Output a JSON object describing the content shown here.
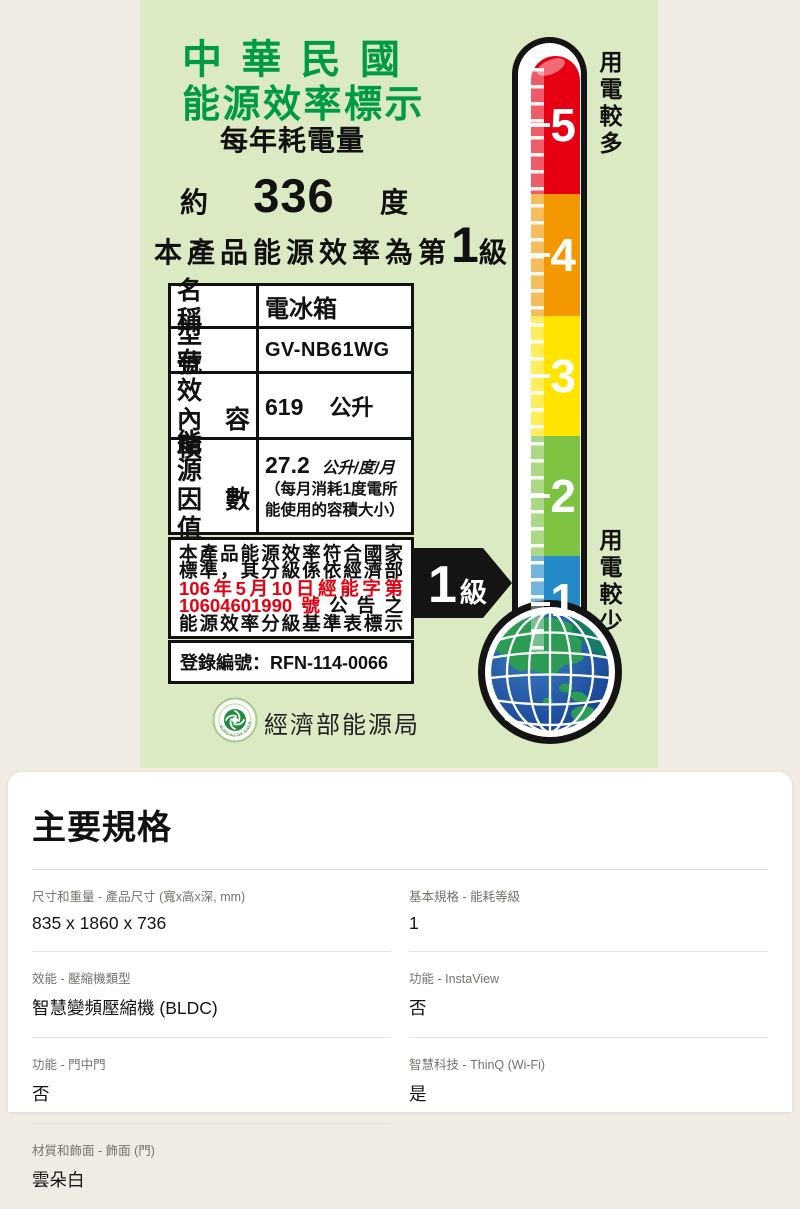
{
  "energy_label": {
    "title_line1": "中 華 民 國",
    "title_line2": "能源效率標示",
    "subtitle": "每年耗電量",
    "consumption": {
      "prefix": "約",
      "value": "336",
      "unit": "度"
    },
    "grade_sentence": {
      "prefix": "本產品能源效率為第",
      "grade": "1",
      "suffix": "級"
    },
    "info_table": {
      "rows": [
        {
          "label_line1": "名　稱",
          "value": "電冰箱"
        },
        {
          "label_line1": "型　號",
          "value": "GV-NB61WG"
        },
        {
          "label_line1": "有　效",
          "label_line2": "內容積",
          "value": "619",
          "unit": "公升"
        },
        {
          "label_line1": "能　源",
          "label_line2": "因數值",
          "value": "27.2",
          "unit": "公升/度/月",
          "note_line1": "（每月消耗1度電所",
          "note_line2": "能使用的容積大小）"
        }
      ]
    },
    "statement": {
      "line1": "本產品能源效率符合國家",
      "line2": "標準，其分級係依經濟部",
      "line3": "106年5月10日經能字第",
      "line4_red": "10604601990號",
      "line4_black": "公告之",
      "line5": "能源效率分級基準表標示"
    },
    "registration": "登錄編號：RFN-114-0066",
    "agency": "經濟部能源局",
    "seal_text": "BUREAU OF ENERGY",
    "grade_badge": {
      "number": "1",
      "suffix": "級"
    },
    "thermometer": {
      "top_label": "用電較多",
      "bottom_label": "用電較少",
      "segments": [
        {
          "number": "5",
          "color": "#e60012"
        },
        {
          "number": "4",
          "color": "#f39800"
        },
        {
          "number": "3",
          "color": "#ffe400"
        },
        {
          "number": "2",
          "color": "#7ec242"
        },
        {
          "number": "1",
          "color": "#2389c7"
        }
      ]
    },
    "colors": {
      "panel_green": "#dbeac2",
      "title_green": "#009a44",
      "accent_red": "#e60012",
      "background_cream": "#f0ece3"
    }
  },
  "specs": {
    "title": "主要規格",
    "left_rows": [
      {
        "label": "尺寸和重量 - 產品尺寸 (寬x高x深, mm)",
        "value": "835 x 1860 x 736"
      },
      {
        "label": "效能 - 壓縮機類型",
        "value": "智慧變頻壓縮機 (BLDC)"
      },
      {
        "label": "功能 - 門中門",
        "value": "否"
      },
      {
        "label": "材質和飾面 - 飾面 (門)",
        "value": "雲朵白"
      }
    ],
    "right_rows": [
      {
        "label": "基本規格 - 能耗等級",
        "value": "1"
      },
      {
        "label": "功能 - InstaView",
        "value": "否"
      },
      {
        "label": "智慧科技 - ThinQ (Wi-Fi)",
        "value": "是"
      }
    ]
  }
}
